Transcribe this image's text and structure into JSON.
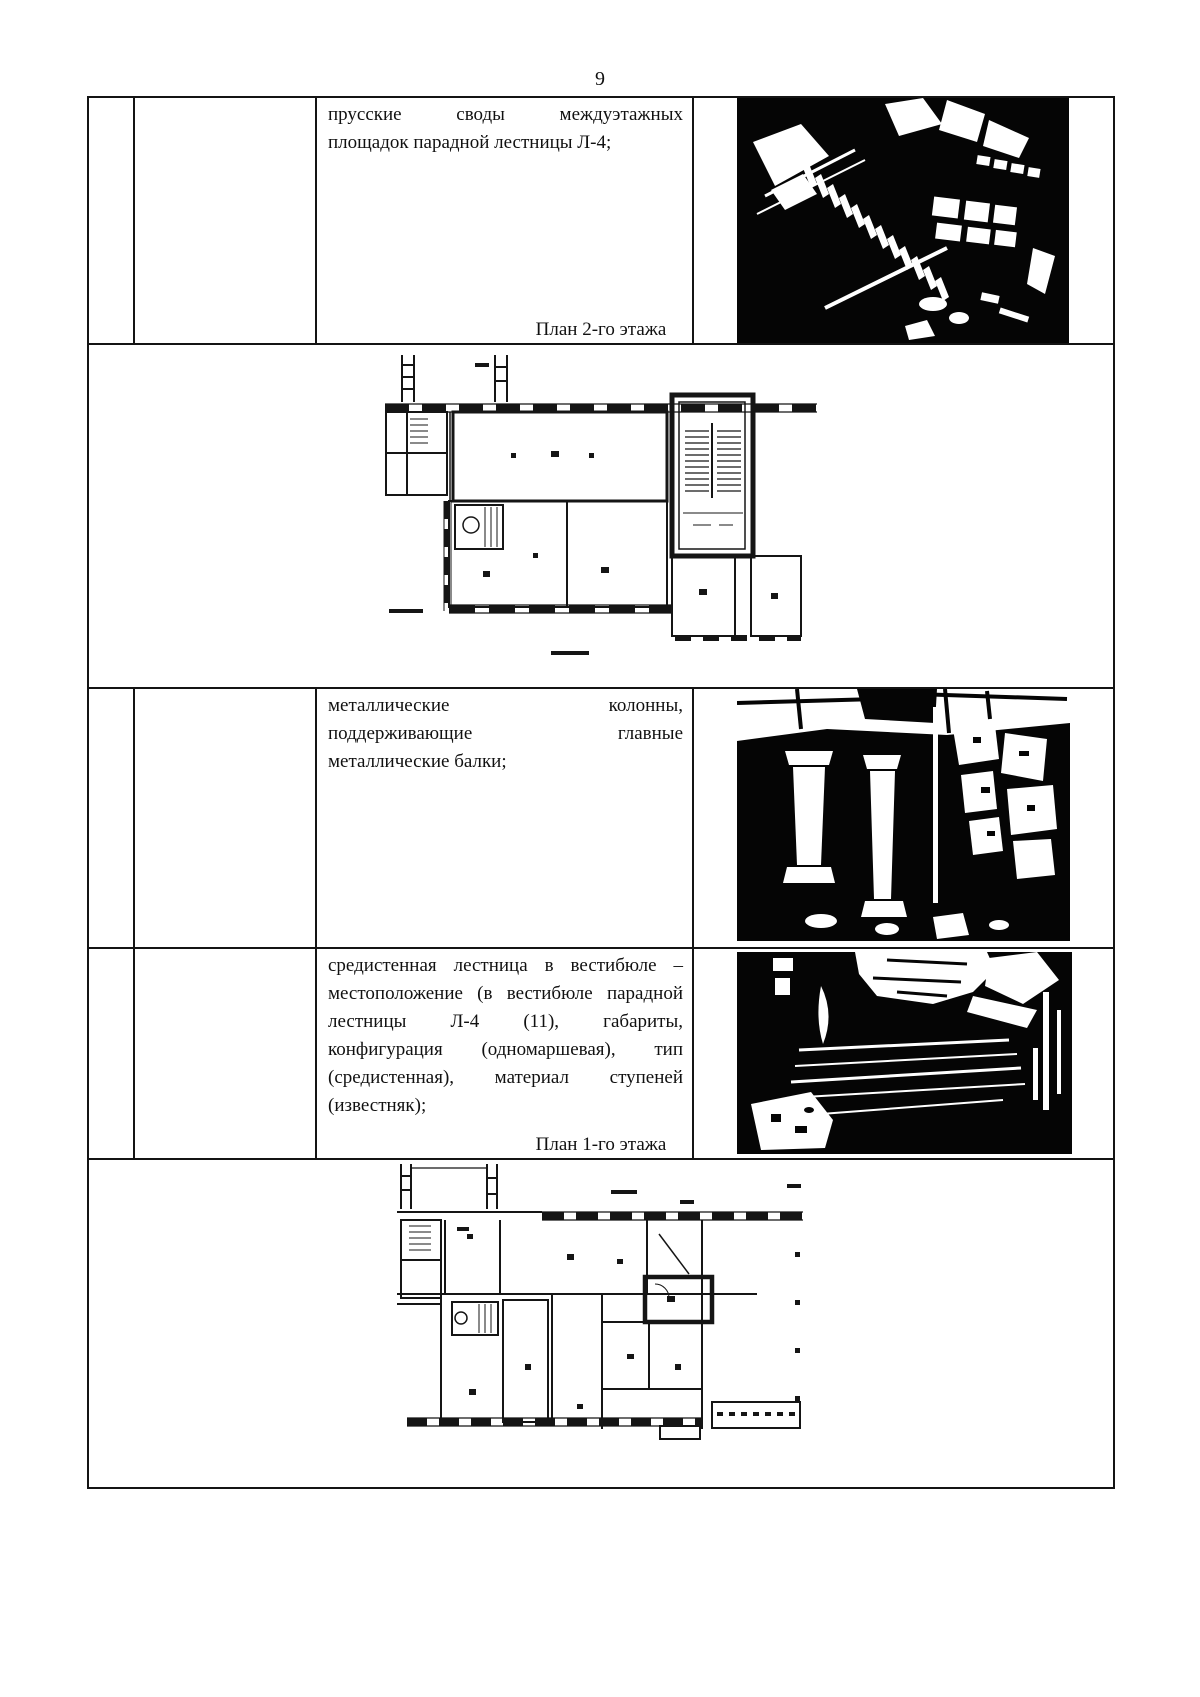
{
  "page": {
    "number": "9"
  },
  "colors": {
    "ink": "#141414",
    "paper": "#ffffff",
    "photo_black": "#050505"
  },
  "table": {
    "row1": {
      "text": "прусские своды междуэтажных площадок парадной лестницы Л-4;",
      "lines": [
        "прусские своды междуэтажных",
        "площадок парадной лестницы Л-4;"
      ],
      "image": "stairwell-top-view-photo"
    },
    "row2": {
      "caption": "План 2-го этажа",
      "image": "floor-plan-2nd-floor"
    },
    "row3": {
      "text": "металлические колонны, поддерживающие главные металлические балки;",
      "lines": [
        "металлические колонны,",
        "поддерживающие главные",
        "металлические балки;"
      ],
      "image": "metal-columns-photo"
    },
    "row4": {
      "text": "средистенная лестница в вестибюле – местоположение (в вестибюле парадной лестницы Л-4 (11), габариты, конфигурация (одномаршевая), тип (средистенная), материал ступеней (известняк);",
      "lines": [
        "средистенная лестница в вестибюле –",
        "местоположение (в вестибюле парадной",
        "лестницы Л-4 (11), габариты,",
        "конфигурация (одномаршевая), тип",
        "(средистенная), материал ступеней",
        "(известняк);"
      ],
      "image": "vestibule-stair-photo"
    },
    "row5": {
      "caption": "План 1-го этажа",
      "image": "floor-plan-1st-floor"
    }
  }
}
